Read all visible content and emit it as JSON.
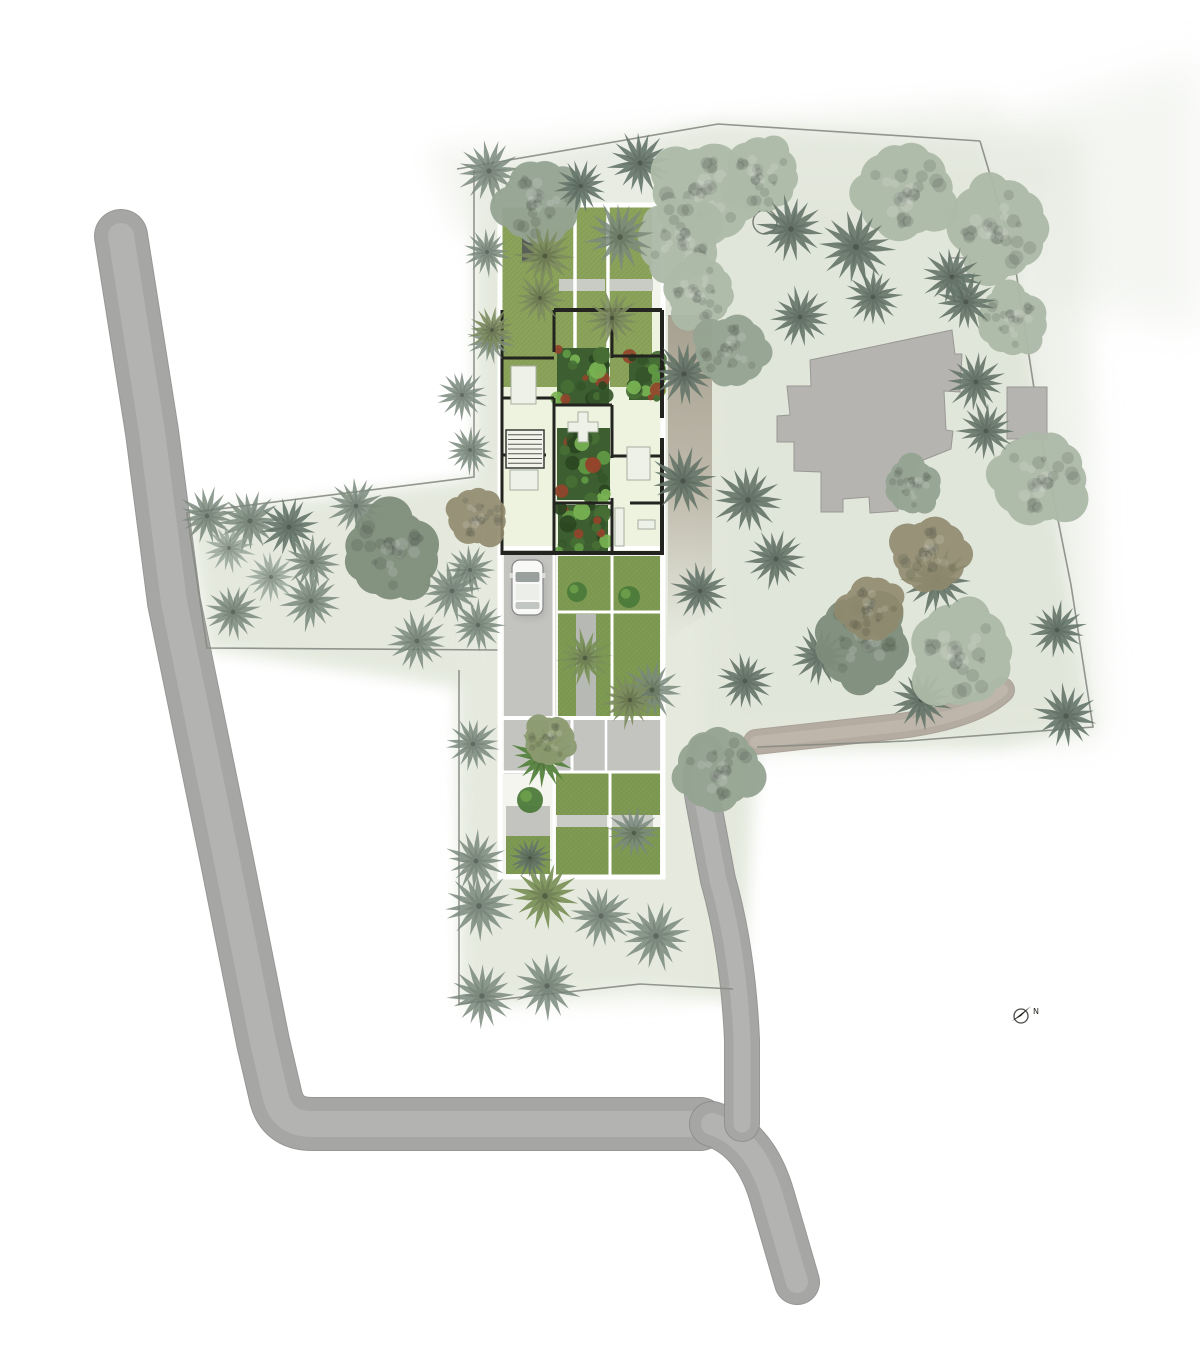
{
  "canvas": {
    "w": 1200,
    "h": 1371,
    "bg": "#ffffff"
  },
  "north_arrow": {
    "label": "N",
    "cx": 1021,
    "cy": 1016,
    "r": 7,
    "needle": [
      [
        1012,
        1021
      ],
      [
        1031,
        1006
      ],
      [
        1021,
        1016
      ]
    ],
    "needle_color": "#1a1a18",
    "ring_color": "#4a4c46",
    "label_left": 1033,
    "label_top": 1008
  },
  "feature_circle": {
    "cx": 765,
    "cy": 222,
    "r": 12,
    "stroke": "#7c8078"
  },
  "palette": {
    "wash": "#e3e8db",
    "road_edge": "#8c8c8a",
    "road_base": "#a6a6a4",
    "road_stripe": "#bdbdbb",
    "path_edge": "#a39a90",
    "path_base": "#b4aba1",
    "path_stripe": "#c6beb4",
    "boundary": "#878b83",
    "bldg_gray": "#b6b4b1",
    "bldg_edge": "#9a9894",
    "annex_white": "#f4f4f1",
    "lawn1": "#8aa25a",
    "lawn2": "#7e9a52",
    "pave": "#c3c4c0",
    "pave2": "#b7bab4",
    "band": "#c9cbc5",
    "room": "#edf3df",
    "wall": "#23231f",
    "white": "#ffffff",
    "furn": "#eef1e7",
    "furn_edge": "#a8aea0",
    "dark_pavilion": "#5a5f58",
    "garden_greens": [
      "#486f35",
      "#35552a",
      "#629a44",
      "#2a4722",
      "#79b354",
      "#94442b"
    ],
    "trees": {
      "pd": "#66766a",
      "pm": "#7b8a7d",
      "pl": "#93a295",
      "po": "#7d8c60",
      "po2": "#7a9158",
      "pg": "#57833f",
      "tl": "#adbaa8",
      "tm": "#95a492",
      "ts": "#7f8e7c",
      "tb": "#908a6e",
      "to": "#8c9a70"
    },
    "tree_opacity": {
      "pd": 0.9,
      "pm": 0.85,
      "pl": 0.8,
      "po": 0.9,
      "po2": 0.92,
      "pg": 0.95,
      "tl": 0.95,
      "tm": 0.95,
      "ts": 0.95,
      "tb": 0.9,
      "to": 0.95
    }
  },
  "washes": [
    {
      "pts": [
        [
          474,
          168
        ],
        [
          718,
          124
        ],
        [
          980,
          141
        ],
        [
          1014,
          252
        ],
        [
          1043,
          440
        ],
        [
          1093,
          728
        ],
        [
          1000,
          748
        ],
        [
          757,
          748
        ],
        [
          742,
          1004
        ],
        [
          640,
          988
        ],
        [
          462,
          1006
        ],
        [
          458,
          688
        ],
        [
          207,
          650
        ],
        [
          187,
          513
        ],
        [
          474,
          478
        ]
      ],
      "f": "#e3e8db",
      "o": 0.92,
      "b": 7
    },
    {
      "pts": [
        [
          430,
          150
        ],
        [
          990,
          100
        ],
        [
          1060,
          190
        ],
        [
          460,
          235
        ]
      ],
      "f": "#ebeee6",
      "o": 0.6,
      "b": 14
    },
    {
      "pts": [
        [
          1000,
          120
        ],
        [
          1200,
          60
        ],
        [
          1200,
          330
        ],
        [
          1050,
          300
        ]
      ],
      "f": "#eaeee6",
      "o": 0.5,
      "b": 20
    },
    {
      "pts": [
        [
          680,
          140
        ],
        [
          1080,
          130
        ],
        [
          1100,
          740
        ],
        [
          700,
          750
        ]
      ],
      "f": "#dfe4d8",
      "o": 0.5,
      "b": 16
    },
    {
      "pts": [
        [
          460,
          480
        ],
        [
          700,
          470
        ],
        [
          700,
          1000
        ],
        [
          465,
          1005
        ]
      ],
      "f": "#e7ebe0",
      "o": 0.6,
      "b": 10
    }
  ],
  "roads": [
    {
      "d": "M121,236 L152,432 L174,602 L226,856 L263,1042 L276,1098 Q283,1124 312,1124 L700,1124",
      "w": 52,
      "warm": false
    },
    {
      "d": "M712,1124 Q755,1138 772,1196 L797,1282",
      "w": 44,
      "warm": false
    },
    {
      "d": "M742,1124 L742,1040 Q738,950 718,880 L703,800 Q698,772 706,752",
      "w": 34,
      "warm": false
    },
    {
      "d": "M756,742 L900,726 Q975,716 1002,690",
      "w": 24,
      "warm": true
    }
  ],
  "side_band": {
    "pts": [
      [
        668,
        315
      ],
      [
        712,
        315
      ],
      [
        712,
        610
      ],
      [
        668,
        640
      ]
    ],
    "grad": [
      "#9c9484",
      "#b0a898",
      "#b7b0a4"
    ]
  },
  "boundary": [
    "M457,169 L718,124 L980,141",
    "M980,141 L1013,252 L1042,440 L1071,585 L1093,727 L907,741 L757,747",
    "M474,170 L474,477 L187,513 L207,648 L498,650",
    "M459,670 L459,1004 L640,984 L733,989"
  ],
  "existing_building": {
    "main_d": "M810,360 L952,330 L955,354 L962,354 L960,392 L944,391 L946,430 L953,431 L951,449 L916,463 L914,485 L898,486 L898,511 L870,513 L869,497 L843,499 L843,512 L821,512 L821,472 L794,471 L794,442 L777,442 L777,416 L790,415 L787,386 L811,386 Z",
    "white_square": {
      "x": 949,
      "y": 258,
      "w": 21,
      "h": 18
    },
    "gray_square": {
      "x": 1007,
      "y": 387,
      "w": 40,
      "h": 52
    }
  },
  "plan": {
    "frame": {
      "x": 500,
      "y": 205,
      "w": 163,
      "h": 672
    },
    "lawns": [
      {
        "x": 502,
        "y": 207,
        "w": 150,
        "h": 180,
        "c": "lawn1"
      },
      {
        "x": 502,
        "y": 310,
        "w": 53,
        "h": 52,
        "c": "lawn1"
      },
      {
        "x": 558,
        "y": 556,
        "w": 102,
        "h": 58,
        "c": "lawn2"
      },
      {
        "x": 558,
        "y": 614,
        "w": 102,
        "h": 104,
        "c": "lawn2"
      },
      {
        "x": 506,
        "y": 836,
        "w": 44,
        "h": 38,
        "c": "lawn2"
      },
      {
        "x": 556,
        "y": 772,
        "w": 104,
        "h": 43,
        "c": "lawn2"
      },
      {
        "x": 556,
        "y": 827,
        "w": 104,
        "h": 49,
        "c": "lawn2"
      }
    ],
    "rooms_base": [
      {
        "x": 502,
        "y": 358,
        "w": 158,
        "h": 197,
        "c": "room"
      },
      {
        "x": 554,
        "y": 308,
        "w": 108,
        "h": 52,
        "c": "room"
      }
    ],
    "pavements": [
      {
        "x": 504,
        "y": 548,
        "w": 52,
        "h": 226,
        "c": "pave"
      },
      {
        "x": 504,
        "y": 720,
        "w": 156,
        "h": 52,
        "c": "pave"
      },
      {
        "x": 506,
        "y": 806,
        "w": 44,
        "h": 30,
        "c": "pave"
      },
      {
        "x": 576,
        "y": 614,
        "w": 20,
        "h": 104,
        "c": "pave2"
      },
      {
        "x": 559,
        "y": 279,
        "w": 46,
        "h": 12,
        "c": "band"
      },
      {
        "x": 610,
        "y": 279,
        "w": 43,
        "h": 12,
        "c": "band"
      },
      {
        "x": 557,
        "y": 815,
        "w": 50,
        "h": 12,
        "c": "band"
      },
      {
        "x": 612,
        "y": 815,
        "w": 41,
        "h": 12,
        "c": "band"
      }
    ],
    "dark_pavilion": {
      "x": 522,
      "y": 229,
      "w": 12,
      "h": 32
    },
    "white_lines": [
      [
        575,
        207,
        575,
        387,
        3.5
      ],
      [
        608,
        207,
        608,
        387,
        3.5
      ],
      [
        612,
        556,
        612,
        718,
        3
      ],
      [
        558,
        612,
        660,
        612,
        3
      ],
      [
        550,
        720,
        550,
        772,
        3
      ],
      [
        572,
        720,
        572,
        772,
        3
      ],
      [
        606,
        720,
        606,
        772,
        2.5
      ],
      [
        610,
        772,
        610,
        876,
        3
      ],
      [
        554,
        548,
        554,
        876,
        3
      ],
      [
        500,
        548,
        663,
        548,
        4
      ],
      [
        500,
        718,
        663,
        718,
        4
      ],
      [
        500,
        772,
        663,
        772,
        3
      ]
    ],
    "walls": [
      [
        554,
        310,
        662,
        310,
        4
      ],
      [
        502,
        358,
        554,
        358,
        3
      ],
      [
        502,
        310,
        502,
        555,
        3
      ],
      [
        554,
        310,
        554,
        352,
        3
      ],
      [
        554,
        398,
        554,
        555,
        3
      ],
      [
        612,
        310,
        612,
        358,
        3
      ],
      [
        612,
        405,
        612,
        458,
        3
      ],
      [
        612,
        498,
        612,
        555,
        3
      ],
      [
        662,
        310,
        662,
        418,
        4
      ],
      [
        662,
        438,
        662,
        555,
        4
      ],
      [
        612,
        356,
        662,
        356,
        3
      ],
      [
        554,
        405,
        612,
        405,
        3
      ],
      [
        612,
        456,
        662,
        456,
        3
      ],
      [
        554,
        503,
        612,
        503,
        3
      ],
      [
        502,
        553,
        662,
        553,
        4
      ],
      [
        502,
        398,
        554,
        398,
        3
      ],
      [
        502,
        455,
        546,
        455,
        3
      ],
      [
        630,
        503,
        662,
        503,
        3
      ]
    ],
    "stairs": {
      "x": 506,
      "y": 430,
      "w": 38,
      "h": 38,
      "steps": 7
    },
    "gardens": [
      {
        "x": 557,
        "y": 348,
        "w": 52,
        "h": 56
      },
      {
        "x": 629,
        "y": 356,
        "w": 31,
        "h": 44
      },
      {
        "x": 557,
        "y": 428,
        "w": 53,
        "h": 72
      },
      {
        "x": 558,
        "y": 505,
        "w": 50,
        "h": 46
      }
    ],
    "shrubs": [
      {
        "cx": 577,
        "cy": 592,
        "r": 10
      },
      {
        "cx": 629,
        "cy": 597,
        "r": 11
      },
      {
        "cx": 530,
        "cy": 800,
        "r": 13
      }
    ],
    "furniture": [
      {
        "t": "rect",
        "x": 511,
        "y": 366,
        "w": 25,
        "h": 38
      },
      {
        "t": "cross",
        "cx": 583,
        "cy": 427,
        "s": 30
      },
      {
        "t": "rect",
        "x": 627,
        "y": 447,
        "w": 23,
        "h": 33
      },
      {
        "t": "rect",
        "x": 615,
        "y": 508,
        "w": 9,
        "h": 38
      },
      {
        "t": "rect",
        "x": 638,
        "y": 520,
        "w": 17,
        "h": 9
      },
      {
        "t": "rect",
        "x": 510,
        "y": 470,
        "w": 28,
        "h": 20
      }
    ],
    "car": {
      "x": 512,
      "y": 560,
      "w": 31,
      "h": 55
    }
  },
  "trees": [
    [
      "p",
      489,
      171,
      1.05,
      "pm"
    ],
    [
      "t",
      540,
      204,
      1.5,
      "tm"
    ],
    [
      "p",
      581,
      186,
      0.9,
      "pd"
    ],
    [
      "p",
      640,
      163,
      1.05,
      "pd"
    ],
    [
      "t",
      703,
      196,
      1.85,
      "tl"
    ],
    [
      "t",
      762,
      176,
      1.35,
      "tl"
    ],
    [
      "p",
      791,
      229,
      1.1,
      "pd"
    ],
    [
      "t",
      905,
      190,
      1.75,
      "tl"
    ],
    [
      "p",
      856,
      247,
      1.25,
      "pd"
    ],
    [
      "t",
      1000,
      228,
      1.8,
      "tl"
    ],
    [
      "p",
      952,
      277,
      1.0,
      "pd"
    ],
    [
      "t",
      678,
      238,
      1.5,
      "tl"
    ],
    [
      "t",
      700,
      292,
      1.25,
      "tl"
    ],
    [
      "p",
      620,
      237,
      1.15,
      "pm"
    ],
    [
      "p",
      545,
      256,
      1.0,
      "po"
    ],
    [
      "p",
      487,
      252,
      0.8,
      "pm"
    ],
    [
      "p",
      540,
      298,
      0.85,
      "po"
    ],
    [
      "p",
      612,
      318,
      0.9,
      "po"
    ],
    [
      "p",
      490,
      340,
      0.8,
      "pm"
    ],
    [
      "p",
      462,
      395,
      0.85,
      "pm"
    ],
    [
      "p",
      470,
      450,
      0.8,
      "pm"
    ],
    [
      "p",
      684,
      374,
      1.05,
      "pd"
    ],
    [
      "t",
      731,
      352,
      1.3,
      "tm"
    ],
    [
      "p",
      800,
      317,
      1.0,
      "pd"
    ],
    [
      "p",
      873,
      297,
      0.95,
      "pd"
    ],
    [
      "p",
      683,
      481,
      1.1,
      "pd"
    ],
    [
      "p",
      748,
      500,
      1.15,
      "pd"
    ],
    [
      "p",
      776,
      559,
      1.0,
      "pd"
    ],
    [
      "p",
      700,
      591,
      0.95,
      "pd"
    ],
    [
      "p",
      652,
      690,
      1.0,
      "pm"
    ],
    [
      "p",
      745,
      681,
      0.95,
      "pd"
    ],
    [
      "t",
      718,
      768,
      1.5,
      "tm"
    ],
    [
      "p",
      820,
      656,
      1.0,
      "pd"
    ],
    [
      "t",
      860,
      641,
      1.7,
      "ts"
    ],
    [
      "p",
      921,
      700,
      1.0,
      "pd"
    ],
    [
      "t",
      963,
      655,
      1.85,
      "tl"
    ],
    [
      "p",
      937,
      580,
      1.15,
      "pd"
    ],
    [
      "p",
      1057,
      630,
      0.95,
      "pd"
    ],
    [
      "p",
      1066,
      716,
      1.05,
      "pd"
    ],
    [
      "t",
      1040,
      477,
      1.7,
      "tl"
    ],
    [
      "p",
      986,
      431,
      0.95,
      "pd"
    ],
    [
      "p",
      976,
      382,
      1.0,
      "pd"
    ],
    [
      "t",
      1011,
      321,
      1.25,
      "tl"
    ],
    [
      "p",
      966,
      302,
      1.0,
      "pd"
    ],
    [
      "t",
      930,
      556,
      1.35,
      "tb"
    ],
    [
      "t",
      872,
      610,
      1.15,
      "tb"
    ],
    [
      "t",
      912,
      486,
      1.0,
      "tm"
    ],
    [
      "p",
      207,
      516,
      0.95,
      "pm"
    ],
    [
      "p",
      250,
      521,
      1.05,
      "pm"
    ],
    [
      "p",
      289,
      527,
      1.0,
      "pd"
    ],
    [
      "p",
      312,
      562,
      0.95,
      "pm"
    ],
    [
      "p",
      229,
      548,
      0.85,
      "pl"
    ],
    [
      "p",
      271,
      577,
      0.85,
      "pl"
    ],
    [
      "p",
      233,
      612,
      0.95,
      "pm"
    ],
    [
      "p",
      311,
      601,
      1.0,
      "pm"
    ],
    [
      "p",
      356,
      506,
      0.95,
      "pm"
    ],
    [
      "t",
      390,
      553,
      1.7,
      "ts"
    ],
    [
      "p",
      452,
      591,
      1.0,
      "pm"
    ],
    [
      "p",
      417,
      641,
      1.0,
      "pm"
    ],
    [
      "t",
      478,
      516,
      1.05,
      "tb"
    ],
    [
      "p",
      478,
      625,
      0.9,
      "pm"
    ],
    [
      "p",
      470,
      570,
      0.85,
      "pm"
    ],
    [
      "p",
      476,
      861,
      1.0,
      "pm"
    ],
    [
      "p",
      479,
      906,
      1.15,
      "pm"
    ],
    [
      "p",
      545,
      896,
      1.15,
      "po2"
    ],
    [
      "p",
      601,
      916,
      1.05,
      "pm"
    ],
    [
      "p",
      656,
      936,
      1.15,
      "pm"
    ],
    [
      "p",
      482,
      996,
      1.1,
      "pm"
    ],
    [
      "p",
      547,
      986,
      1.1,
      "pm"
    ],
    [
      "p",
      492,
      330,
      0.8,
      "po"
    ],
    [
      "p",
      585,
      658,
      0.95,
      "po2"
    ],
    [
      "p",
      630,
      700,
      0.95,
      "po"
    ],
    [
      "p",
      543,
      757,
      1.05,
      "pg"
    ],
    [
      "t",
      549,
      741,
      0.9,
      "to"
    ],
    [
      "p",
      473,
      744,
      0.9,
      "pm"
    ],
    [
      "p",
      634,
      833,
      0.9,
      "pm"
    ],
    [
      "p",
      530,
      858,
      0.7,
      "pd"
    ]
  ]
}
